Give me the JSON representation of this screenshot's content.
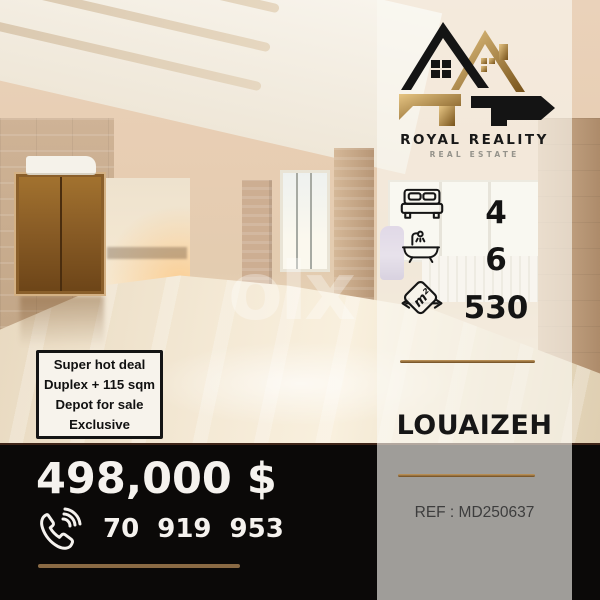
{
  "agency": {
    "name": "ROYAL REALITY",
    "tagline": "REAL ESTATE"
  },
  "listing": {
    "location": "LOUAIZEH",
    "price": "498,000 $",
    "phone": "70 919 953",
    "reference": "REF : MD250637",
    "area_unit": "m²",
    "stats": [
      {
        "icon": "bed-icon",
        "value": "4"
      },
      {
        "icon": "bathtub-icon",
        "value": "6"
      },
      {
        "icon": "area-icon",
        "value": "530"
      }
    ],
    "highlights": [
      "Super hot deal",
      "Duplex + 115 sqm",
      "Depot for sale",
      "Exclusive"
    ]
  },
  "watermark": "olx",
  "colors": {
    "gold_divider": "#8a6a44",
    "logo_gold": "#c9a063",
    "logo_black": "#141414",
    "bar_black": "#0b0908",
    "sidebar_cream": "#f1e9dc",
    "panel_gray": "#9e9e9e",
    "highlight_box_bg": "#f7f3ec"
  }
}
